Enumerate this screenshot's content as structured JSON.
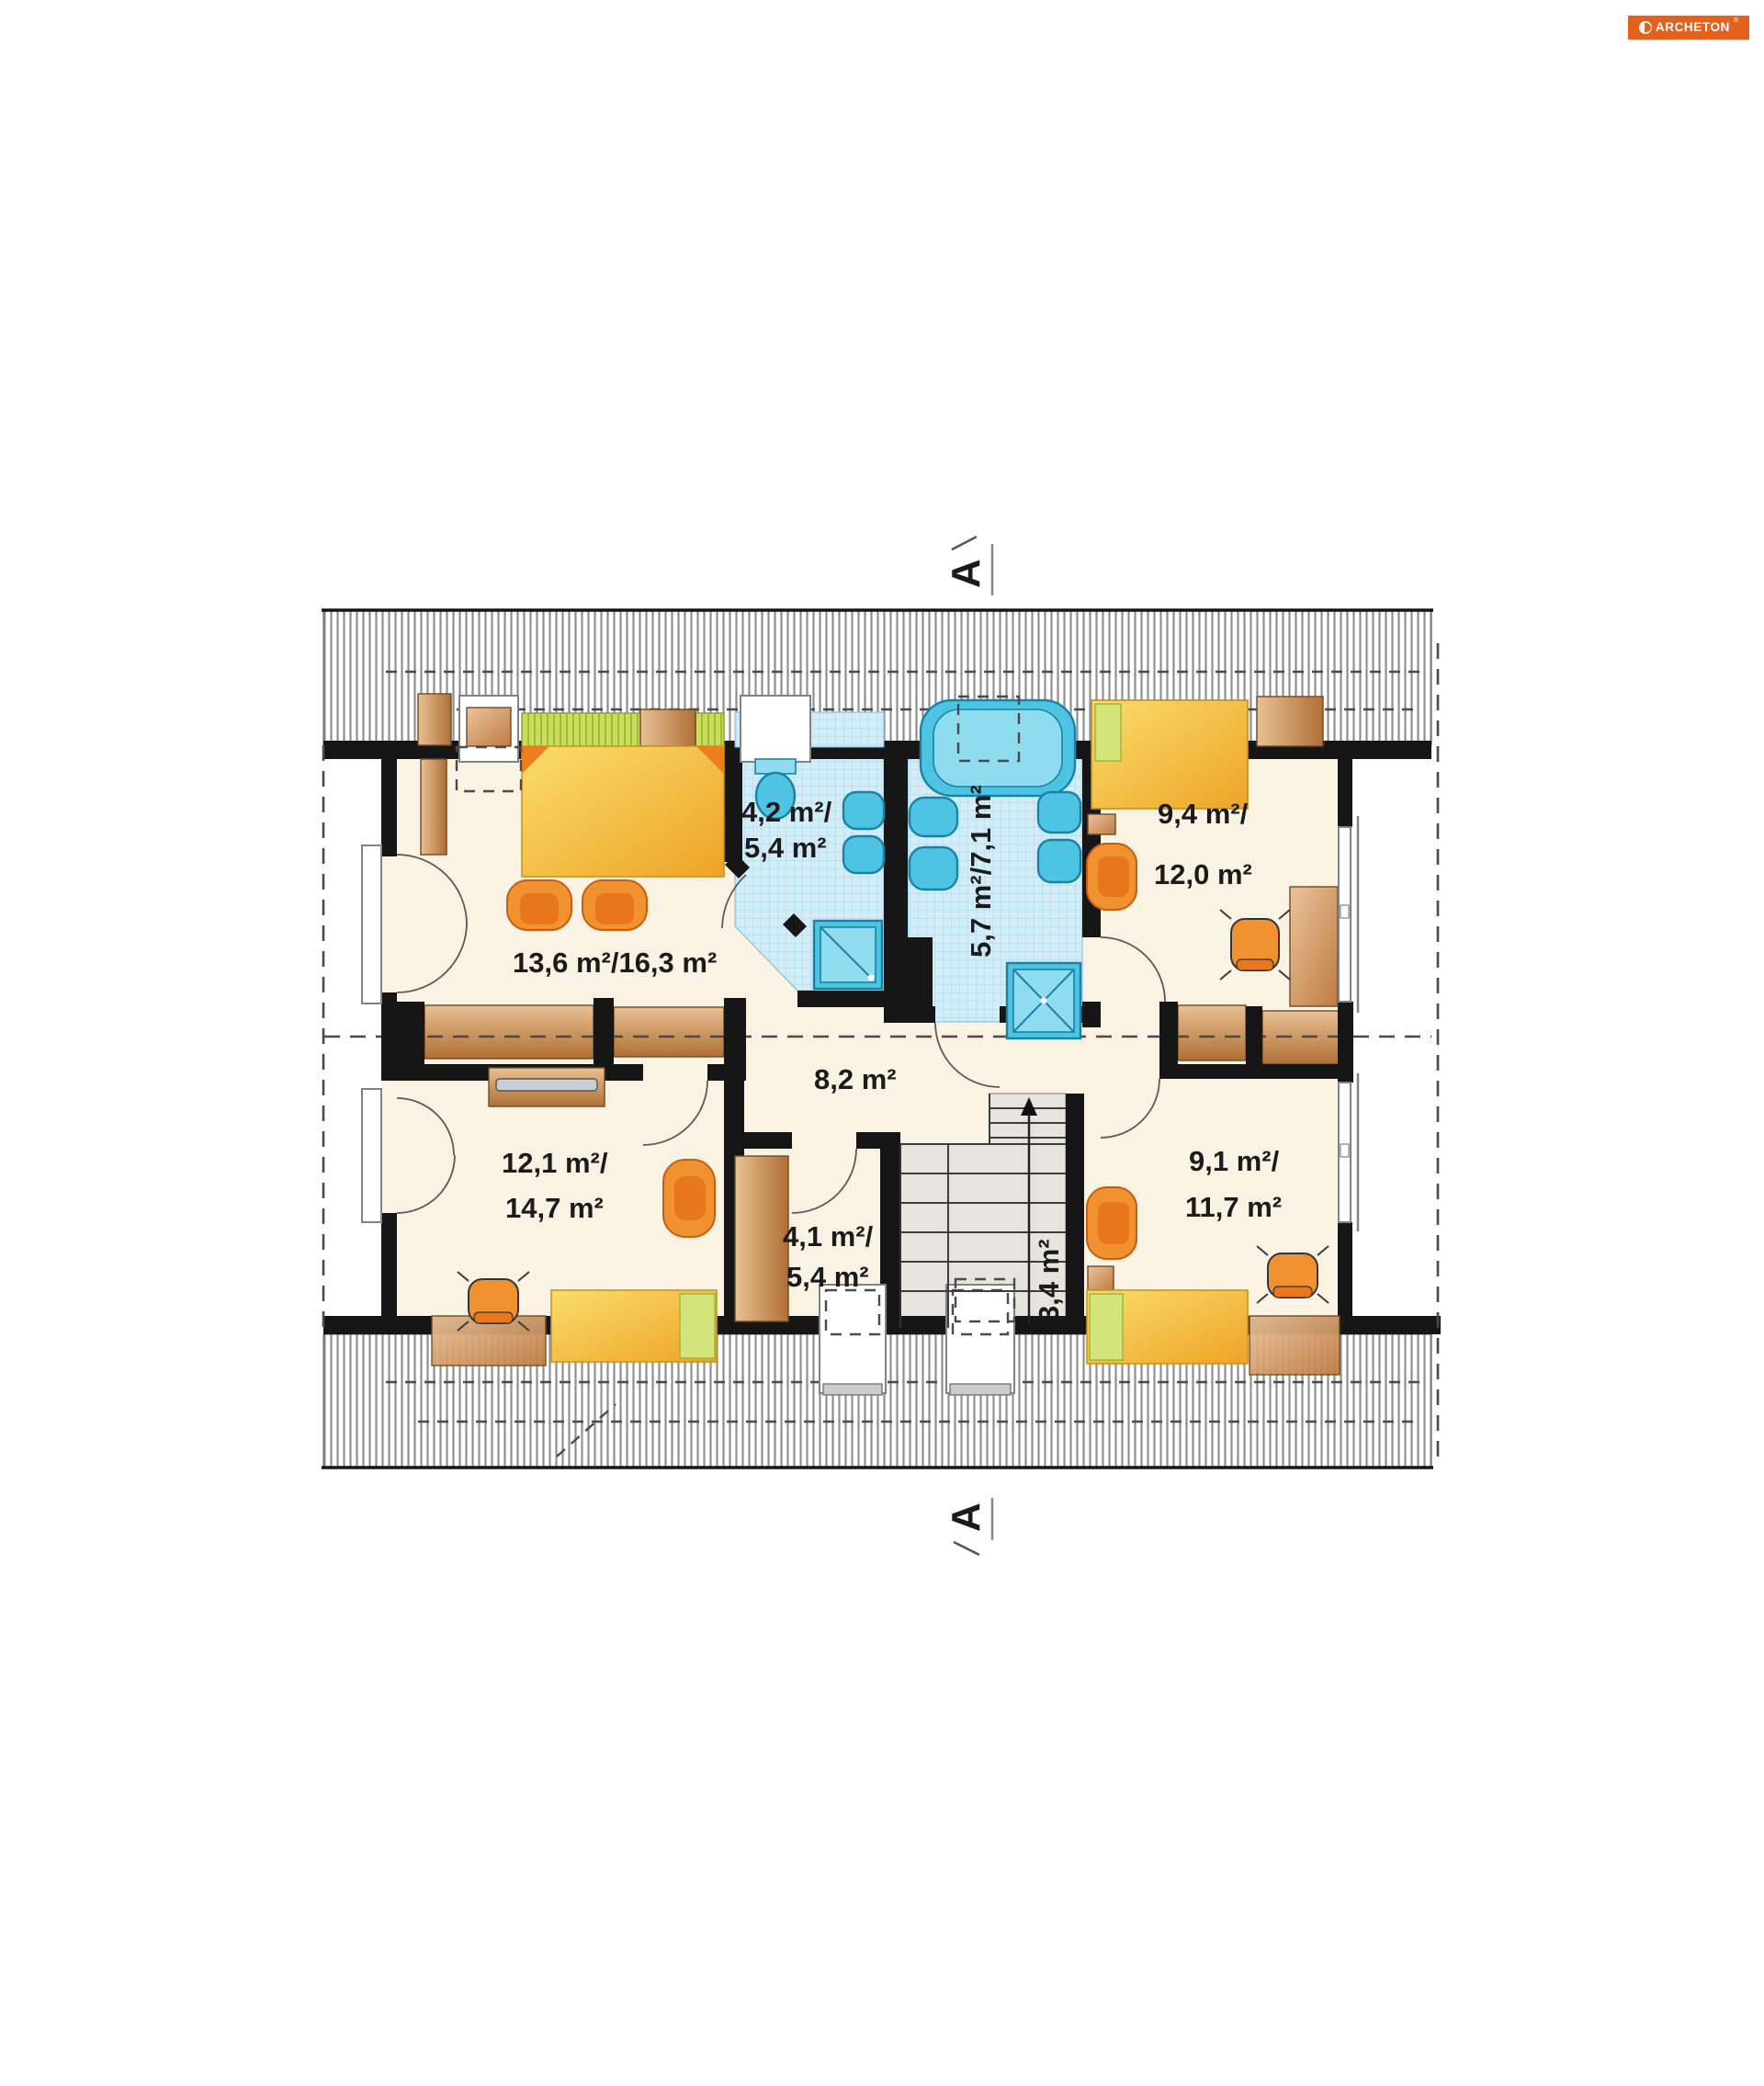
{
  "logo": {
    "text": "ARCHETON",
    "registered": "®",
    "bg_color": "#E2611C",
    "text_color": "#FFFFFF"
  },
  "section_markers": {
    "top": {
      "letter": "A"
    },
    "bottom": {
      "letter": "A"
    }
  },
  "rooms": [
    {
      "id": "bedroom-top-left",
      "area_label": "13,6 m²/16,3 m²"
    },
    {
      "id": "bathroom-small",
      "area_line1": "4,2 m²/",
      "area_line2": "5,4 m²"
    },
    {
      "id": "bathroom-large",
      "area_label": "5,7 m²/7,1 m²"
    },
    {
      "id": "room-top-right",
      "area_line1": "9,4 m²/",
      "area_line2": "12,0 m²"
    },
    {
      "id": "hall",
      "area_label": "8,2 m²"
    },
    {
      "id": "room-bottom-left",
      "area_line1": "12,1 m²/",
      "area_line2": "14,7 m²"
    },
    {
      "id": "wardrobe",
      "area_line1": "4,1 m²/",
      "area_line2": "5,4 m²"
    },
    {
      "id": "staircase",
      "area_label": "3,4 m²"
    },
    {
      "id": "room-bottom-right",
      "area_line1": "9,1 m²/",
      "area_line2": "11,7 m²"
    }
  ],
  "colors": {
    "floor_cream": "#FAF2E3",
    "wall_black": "#161616",
    "roof_hatch_line": "#8F8F8F",
    "bath_tile": "#D3EDF8",
    "bath_tile_grid": "#A6D8EA",
    "fixture_cyan": "#4FC4E2",
    "fixture_stroke": "#1783A8",
    "stairs_gray": "#E7E4DD",
    "bed_yellow": "#F4C23F",
    "pillow_lime": "#CBDD5F",
    "chair_orange": "#F29130",
    "wood_brown": "#C8853F",
    "desk_copper": "#D89A5E",
    "logo_orange": "#E2611C"
  }
}
